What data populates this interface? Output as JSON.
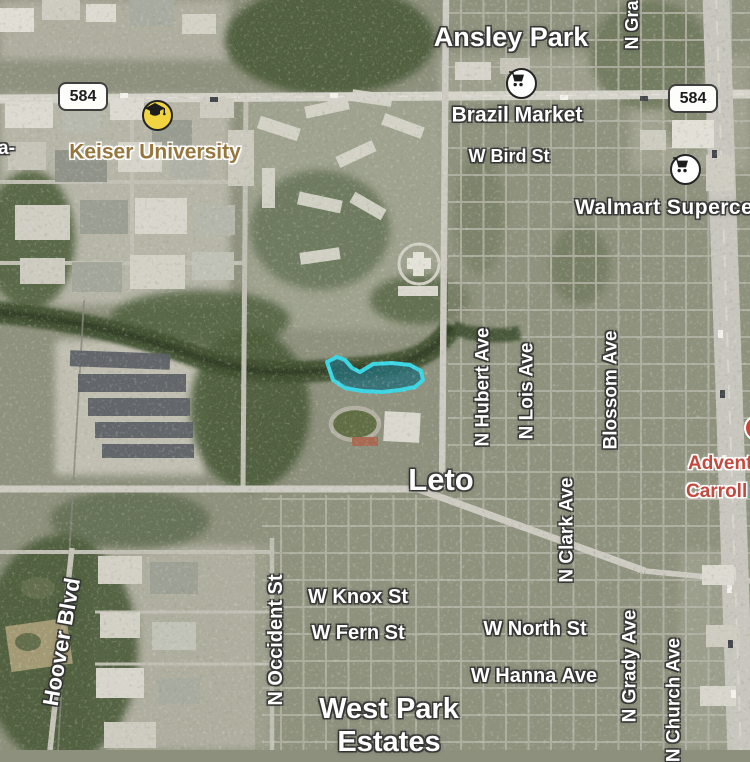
{
  "map": {
    "mode": "satellite",
    "place_labels": {
      "ansley_park": "Ansley Park",
      "leto": "Leto",
      "west_park_line1": "West Park",
      "west_park_line2": "Estates",
      "edge_fragment_left": "a-"
    },
    "poi_labels": {
      "keiser": "Keiser University",
      "brazil_market": "Brazil Market",
      "walmart": "Walmart Superce",
      "advent_line1": "Advent",
      "advent_line2": "Carroll"
    },
    "street_labels": {
      "w_bird": "W Bird St",
      "w_knox": "W Knox St",
      "w_fern": "W Fern St",
      "w_north": "W North St",
      "w_hanna": "W Hanna Ave",
      "n_gra": "N Gra",
      "n_hubert": "N Hubert Ave",
      "n_lois": "N Lois Ave",
      "blossom": "Blossom Ave",
      "n_clark": "N Clark Ave",
      "n_grady": "N Grady Ave",
      "n_church": "N Church Ave",
      "n_occident": "N Occident St",
      "hoover": "Hoover Blvd"
    },
    "shields": {
      "route": "584"
    },
    "icons": {
      "keiser": "graduation-cap-icon",
      "brazil_market": "shopping-cart-icon",
      "walmart": "shopping-cart-icon",
      "hospital": "hospital-marker-icon"
    },
    "colors": {
      "school_label": "#97763d",
      "hospital_label": "#c4483d",
      "selection_highlight": "#35d8e8",
      "shield_background": "#fdfdfa",
      "shield_border": "#3f3f3f",
      "poi_school_fill": "#f2d441",
      "poi_store_fill": "#ffffff",
      "hospital_marker": "#c9463c"
    }
  }
}
